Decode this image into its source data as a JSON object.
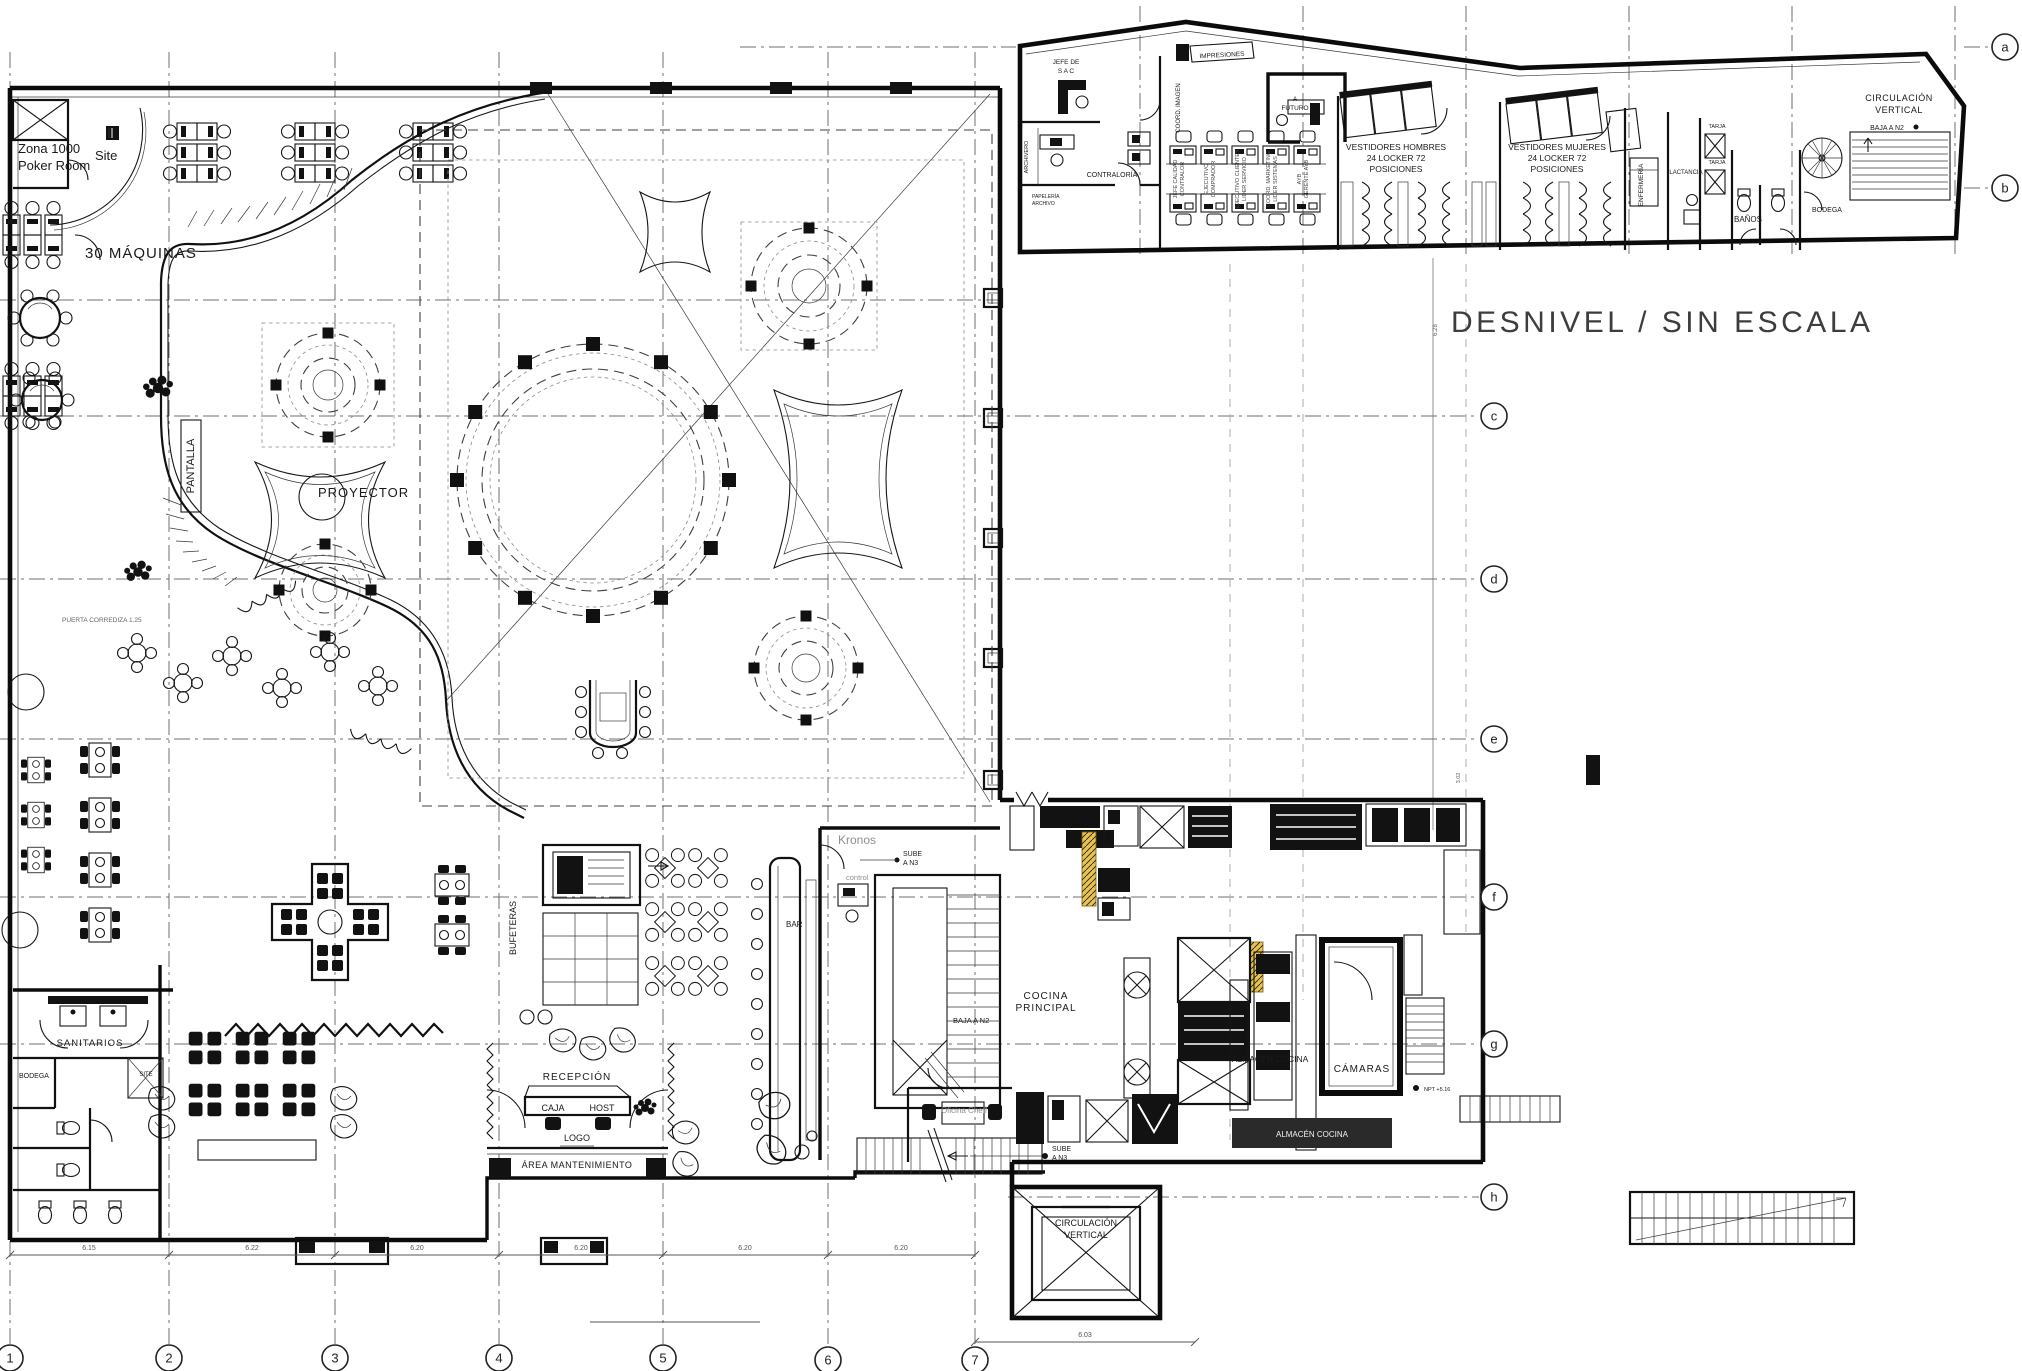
{
  "drawing": {
    "kind": "architectural floor plan",
    "scale_note": "DESNIVEL   /   SIN ESCALA"
  },
  "colors": {
    "ink": "#1a1a1a",
    "gray_text": "#8f8f8f",
    "muted": "#555555",
    "title": "#3d3d3d",
    "accent_yellow": "#e7c34b",
    "white_text": "#f2f2f2"
  },
  "title_note": {
    "text": "DESNIVEL   /   SIN ESCALA",
    "x": 1451,
    "y": 332,
    "size": 30
  },
  "grid": {
    "letter_bubbles": [
      {
        "label": "a",
        "x": 2005,
        "y": 47
      },
      {
        "label": "b",
        "x": 2005,
        "y": 188
      },
      {
        "label": "c",
        "x": 1494,
        "y": 416
      },
      {
        "label": "d",
        "x": 1494,
        "y": 579
      },
      {
        "label": "e",
        "x": 1494,
        "y": 739
      },
      {
        "label": "f",
        "x": 1494,
        "y": 897
      },
      {
        "label": "g",
        "x": 1494,
        "y": 1044
      },
      {
        "label": "h",
        "x": 1494,
        "y": 1197
      }
    ],
    "number_bubbles": [
      {
        "label": "1",
        "x": 10,
        "y": 1358
      },
      {
        "label": "2",
        "x": 169,
        "y": 1358
      },
      {
        "label": "3",
        "x": 335,
        "y": 1358
      },
      {
        "label": "4",
        "x": 499,
        "y": 1358
      },
      {
        "label": "5",
        "x": 663,
        "y": 1358
      },
      {
        "label": "6",
        "x": 828,
        "y": 1360
      },
      {
        "label": "7",
        "x": 975,
        "y": 1360
      }
    ],
    "bottom_dimensions": [
      {
        "text": "6.15",
        "x": 89,
        "y": 1250
      },
      {
        "text": "6.22",
        "x": 252,
        "y": 1250
      },
      {
        "text": "6.20",
        "x": 417,
        "y": 1250
      },
      {
        "text": "6.20",
        "x": 581,
        "y": 1250
      },
      {
        "text": "6.20",
        "x": 745,
        "y": 1250
      },
      {
        "text": "6.20",
        "x": 901,
        "y": 1250
      }
    ],
    "right_dimension": {
      "text": "6.03",
      "x": 1085,
      "y": 1337
    }
  },
  "labels": [
    {
      "n": "zona-poker-line1",
      "t": "Zona 1000",
      "x": 18,
      "y": 153,
      "s": 13,
      "a": "start"
    },
    {
      "n": "zona-poker-line2",
      "t": "Poker Room",
      "x": 18,
      "y": 170,
      "s": 13,
      "a": "start"
    },
    {
      "n": "site-room",
      "t": "Site",
      "x": 95,
      "y": 160,
      "s": 13,
      "a": "start"
    },
    {
      "n": "maquinas",
      "t": "30 MÁQUINAS",
      "x": 85,
      "y": 258,
      "s": 15,
      "a": "start",
      "ls": 1
    },
    {
      "n": "pantalla",
      "t": "PANTALLA",
      "x": 194,
      "y": 466,
      "s": 11,
      "r": -90
    },
    {
      "n": "proyector",
      "t": "PROYECTOR",
      "x": 318,
      "y": 497,
      "s": 13,
      "a": "start",
      "ls": 1
    },
    {
      "n": "puerta-corrediza",
      "t": "PUERTA CORREDIZA 1.25",
      "x": 62,
      "y": 622,
      "s": 6.5,
      "a": "start",
      "c": "#666666"
    },
    {
      "n": "sanitarios",
      "t": "SANITARIOS",
      "x": 90,
      "y": 1046,
      "s": 9.5,
      "ls": 1
    },
    {
      "n": "bodega-sanitarios",
      "t": "BODEGA",
      "x": 34,
      "y": 1078,
      "s": 7
    },
    {
      "n": "site-closet",
      "t": "SITE",
      "x": 146,
      "y": 1076,
      "s": 6
    },
    {
      "n": "bufeteras",
      "t": "BUFETERAS",
      "x": 516,
      "y": 928,
      "s": 9,
      "r": -90
    },
    {
      "n": "recepcion",
      "t": "RECEPCIÓN",
      "x": 577,
      "y": 1080,
      "s": 10,
      "ls": 1
    },
    {
      "n": "caja",
      "t": "CAJA",
      "x": 553,
      "y": 1111,
      "s": 9
    },
    {
      "n": "host",
      "t": "HOST",
      "x": 602,
      "y": 1111,
      "s": 9
    },
    {
      "n": "logo",
      "t": "LOGO",
      "x": 577,
      "y": 1141,
      "s": 9
    },
    {
      "n": "area-mantenimiento",
      "t": "ÁREA MANTENIMIENTO",
      "x": 577,
      "y": 1168,
      "s": 9,
      "ls": 0.5
    },
    {
      "n": "bar-main",
      "t": "BAR",
      "x": 786,
      "y": 927,
      "s": 8,
      "a": "start"
    },
    {
      "n": "kronos",
      "t": "Kronos",
      "x": 838,
      "y": 844,
      "s": 12,
      "a": "start",
      "c": "#8f8f8f"
    },
    {
      "n": "sube-kronos-1",
      "t": "SUBE",
      "x": 903,
      "y": 856,
      "s": 7,
      "a": "start"
    },
    {
      "n": "sube-kronos-2",
      "t": "A N3",
      "x": 903,
      "y": 865,
      "s": 7,
      "a": "start"
    },
    {
      "n": "control",
      "t": "control",
      "x": 846,
      "y": 880,
      "s": 7.5,
      "a": "start",
      "c": "#8f8f8f"
    },
    {
      "n": "cocina-principal-1",
      "t": "COCINA",
      "x": 1046,
      "y": 999,
      "s": 10,
      "ls": 1
    },
    {
      "n": "cocina-principal-2",
      "t": "PRINCIPAL",
      "x": 1046,
      "y": 1011,
      "s": 10,
      "ls": 1
    },
    {
      "n": "baja-kronos",
      "t": "BAJA A N2",
      "x": 953,
      "y": 1023,
      "s": 7.5,
      "a": "start"
    },
    {
      "n": "oficina-cheff",
      "t": "Oficina Cheff",
      "x": 964,
      "y": 1113,
      "s": 8,
      "c": "#8f8f8f"
    },
    {
      "n": "sube-kitchen-1",
      "t": "SUBE",
      "x": 1052,
      "y": 1151,
      "s": 7,
      "a": "start"
    },
    {
      "n": "sube-kitchen-2",
      "t": "A N3",
      "x": 1052,
      "y": 1160,
      "s": 7,
      "a": "start"
    },
    {
      "n": "almacen-cocina-1",
      "t": "ALMACÉN COCINA",
      "x": 1270,
      "y": 1062,
      "s": 8.5
    },
    {
      "n": "camaras",
      "t": "CÁMARAS",
      "x": 1362,
      "y": 1072,
      "s": 10,
      "ls": 1
    },
    {
      "n": "almacen-cocina-2",
      "t": "ALMACÉN COCINA",
      "x": 1312,
      "y": 1137,
      "s": 8,
      "c": "#f2f2f2"
    },
    {
      "n": "npt-level",
      "t": "NPT +5.16",
      "x": 1424,
      "y": 1091,
      "s": 5.5,
      "a": "start"
    },
    {
      "n": "circ-vert-main-1",
      "t": "CIRCULACIÓN",
      "x": 1086,
      "y": 1226,
      "s": 9
    },
    {
      "n": "circ-vert-main-2",
      "t": "VERTICAL",
      "x": 1086,
      "y": 1238,
      "s": 9
    },
    {
      "n": "jefe-sac-1",
      "t": "JEFE DE",
      "x": 1066,
      "y": 64,
      "s": 6.5
    },
    {
      "n": "jefe-sac-2",
      "t": "S  A  C",
      "x": 1066,
      "y": 73,
      "s": 6.5
    },
    {
      "n": "contraloria",
      "t": "CONTRALORÍA",
      "x": 1112,
      "y": 177,
      "s": 7
    },
    {
      "n": "archivero",
      "t": "ARCHIVERO",
      "x": 1028,
      "y": 157,
      "s": 5.5,
      "r": -90
    },
    {
      "n": "papeleria-1",
      "t": "PAPELERÍA",
      "x": 1032,
      "y": 198,
      "s": 5,
      "a": "start"
    },
    {
      "n": "papeleria-2",
      "t": "ARCHIVO",
      "x": 1032,
      "y": 205,
      "s": 5,
      "a": "start"
    },
    {
      "n": "impresiones",
      "t": "IMPRESIONES",
      "x": 1222,
      "y": 57,
      "s": 6.5,
      "r": -3
    },
    {
      "n": "coord-imagen",
      "t": "COORD. IMAGEN",
      "x": 1180,
      "y": 108,
      "s": 6,
      "r": -90
    },
    {
      "n": "a-futuro-1",
      "t": "A",
      "x": 1295,
      "y": 101,
      "s": 6.5
    },
    {
      "n": "a-futuro-2",
      "t": "FUTURO",
      "x": 1295,
      "y": 110,
      "s": 6.5
    },
    {
      "n": "pod-1a",
      "t": "JEFE CALIDAD",
      "x": 1177,
      "y": 179,
      "s": 5.5,
      "r": -90,
      "c": "#444444"
    },
    {
      "n": "pod-1b",
      "t": "CONTRALOR",
      "x": 1184,
      "y": 179,
      "s": 5.5,
      "r": -90,
      "c": "#444444"
    },
    {
      "n": "pod-2a",
      "t": "EJECUTIVO",
      "x": 1208,
      "y": 179,
      "s": 5.5,
      "r": -90,
      "c": "#444444"
    },
    {
      "n": "pod-2b",
      "t": "COMPRADOR",
      "x": 1215,
      "y": 179,
      "s": 5.5,
      "r": -90,
      "c": "#444444"
    },
    {
      "n": "pod-3a",
      "t": "EJECUTIVO CLIENTES",
      "x": 1239,
      "y": 179,
      "s": 5.5,
      "r": -90,
      "c": "#444444"
    },
    {
      "n": "pod-3b",
      "t": "LIDER SERVICIO",
      "x": 1246,
      "y": 179,
      "s": 5.5,
      "r": -90,
      "c": "#444444"
    },
    {
      "n": "pod-4a",
      "t": "COORD. MARKETING",
      "x": 1270,
      "y": 179,
      "s": 5.5,
      "r": -90,
      "c": "#444444"
    },
    {
      "n": "pod-4b",
      "t": "LIDER SISTEMAS",
      "x": 1277,
      "y": 179,
      "s": 5.5,
      "r": -90,
      "c": "#444444"
    },
    {
      "n": "pod-5a",
      "t": "AYB",
      "x": 1301,
      "y": 179,
      "s": 5.5,
      "r": -90,
      "c": "#444444"
    },
    {
      "n": "pod-5b",
      "t": "GERENTE AYB",
      "x": 1308,
      "y": 179,
      "s": 5.5,
      "r": -90,
      "c": "#444444"
    },
    {
      "n": "vestidores-h-1",
      "t": "VESTIDORES HOMBRES",
      "x": 1396,
      "y": 150,
      "s": 8.5
    },
    {
      "n": "vestidores-h-2",
      "t": "24 LOCKER 72",
      "x": 1396,
      "y": 161,
      "s": 8.5
    },
    {
      "n": "vestidores-h-3",
      "t": "POSICIONES",
      "x": 1396,
      "y": 172,
      "s": 8.5
    },
    {
      "n": "vestidores-m-1",
      "t": "VESTIDORES MUJERES",
      "x": 1557,
      "y": 150,
      "s": 8.5
    },
    {
      "n": "vestidores-m-2",
      "t": "24 LOCKER 72",
      "x": 1557,
      "y": 161,
      "s": 8.5
    },
    {
      "n": "vestidores-m-3",
      "t": "POSICIONES",
      "x": 1557,
      "y": 172,
      "s": 8.5
    },
    {
      "n": "enfermeria",
      "t": "ENFERMERÍA",
      "x": 1643,
      "y": 185,
      "s": 6.5,
      "r": -90
    },
    {
      "n": "lactancia",
      "t": "LACTANCIA",
      "x": 1686,
      "y": 174,
      "s": 6
    },
    {
      "n": "tarja-1",
      "t": "TARJA",
      "x": 1717,
      "y": 128,
      "s": 5.5
    },
    {
      "n": "tarja-2",
      "t": "TARJA",
      "x": 1717,
      "y": 164,
      "s": 5.5
    },
    {
      "n": "banos",
      "t": "BAÑOS",
      "x": 1748,
      "y": 222,
      "s": 8
    },
    {
      "n": "bodega-strip",
      "t": "BODEGA",
      "x": 1827,
      "y": 212,
      "s": 7
    },
    {
      "n": "circ-vert-strip-1",
      "t": "CIRCULACIÓN",
      "x": 1899,
      "y": 101,
      "s": 9,
      "ls": 0.5
    },
    {
      "n": "circ-vert-strip-2",
      "t": "VERTICAL",
      "x": 1899,
      "y": 113,
      "s": 9,
      "ls": 0.5
    },
    {
      "n": "baja-strip",
      "t": "BAJA A N2",
      "x": 1887,
      "y": 130,
      "s": 7
    },
    {
      "n": "dim-628",
      "t": "6.28",
      "x": 1437,
      "y": 330,
      "s": 6,
      "r": -90,
      "c": "#666666"
    },
    {
      "n": "dim-302",
      "t": "3.02",
      "x": 1460,
      "y": 778,
      "s": 5.5,
      "r": -90,
      "c": "#666666"
    }
  ]
}
